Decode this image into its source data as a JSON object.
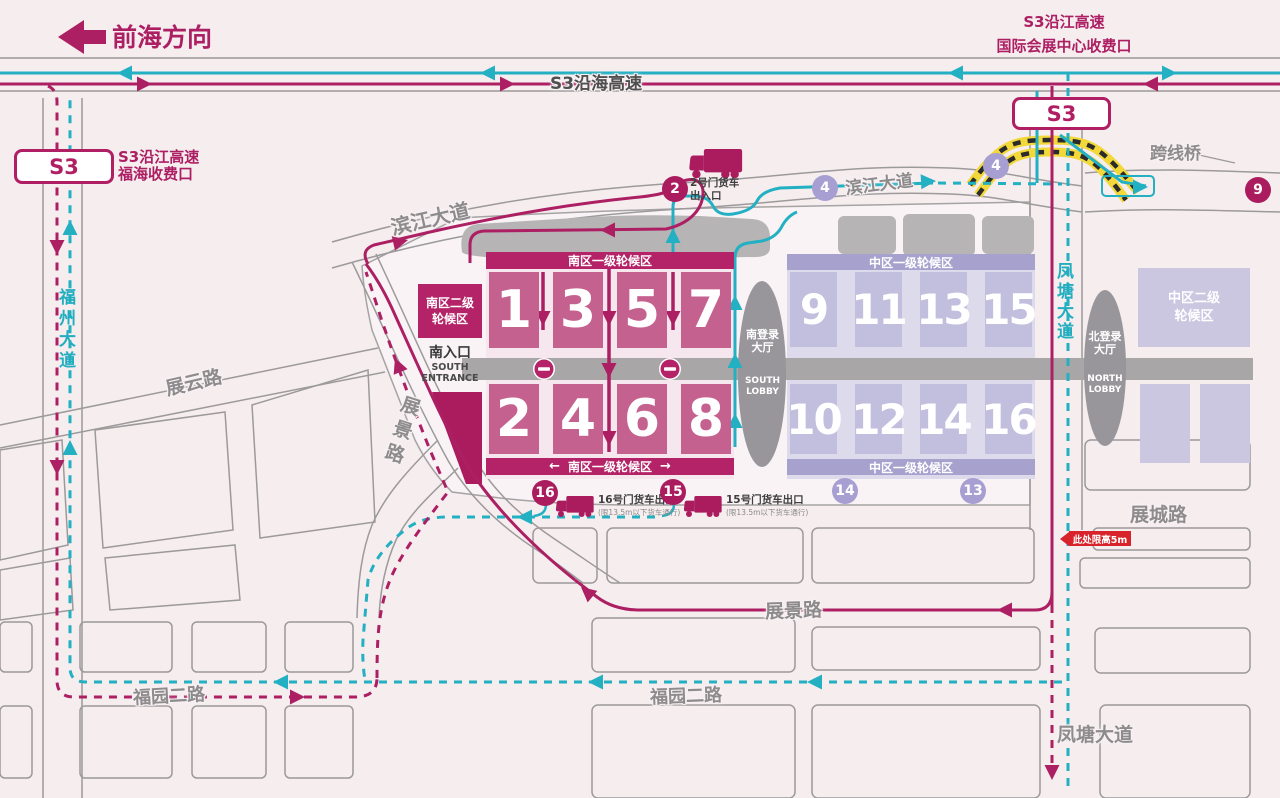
{
  "colors": {
    "background": "#f6edef",
    "magenta": "#ad1f63",
    "magenta_dark": "#b42367",
    "teal": "#22b0c2",
    "hall_south": "#c5618e",
    "zone_south": "#f5e7ed",
    "banner_south": "#b42367",
    "hall_central": "#c2bede",
    "zone_central": "#dddaec",
    "banner_central": "#a7a1ce",
    "waypoint_purple": "#a79fd2",
    "building_gray": "#b6b4b5",
    "road_gray": "#9b999a",
    "label_gray": "#8d8b8c",
    "alert_red": "#d8232a",
    "bridge_yellow": "#f3d83a"
  },
  "highway": {
    "qianhai_direction": "前海方向",
    "s3_coastal": "S3沿海高速",
    "s3_badge": "S3",
    "toll_right_line1": "S3沿江高速",
    "toll_right_line2": "国际会展中心收费口",
    "toll_left_line1": "S3沿江高速",
    "toll_left_line2": "福海收费口",
    "bridge": "跨线桥"
  },
  "roads": {
    "fuzhou_avenue": "福州大道",
    "binjiang_avenue": "滨江大道",
    "fengtang_avenue": "凤塘大道",
    "zhanyun_road": "展云路",
    "zhanjing_road": "展景路",
    "fuyuan_2nd_road": "福园二路",
    "zhancheng_road": "展城路"
  },
  "venue": {
    "south_zone_banner": "南区一级轮候区",
    "south_zone2_line1": "南区二级",
    "south_zone2_line2": "轮候区",
    "central_zone_banner": "中区一级轮候区",
    "central_zone2_line1": "中区二级",
    "central_zone2_line2": "轮候区",
    "south_entrance_cn": "南入口",
    "south_entrance_en1": "SOUTH",
    "south_entrance_en2": "ENTRANCE",
    "south_lobby_cn1": "南登录",
    "south_lobby_cn2": "大厅",
    "south_lobby_en1": "SOUTH",
    "south_lobby_en2": "LOBBY",
    "north_lobby_cn1": "北登录",
    "north_lobby_cn2": "大厅",
    "north_lobby_en1": "NORTH",
    "north_lobby_en2": "LOBBY",
    "halls_south": [
      "1",
      "3",
      "5",
      "7",
      "2",
      "4",
      "6",
      "8"
    ],
    "halls_central": [
      "9",
      "11",
      "13",
      "15",
      "10",
      "12",
      "14",
      "16"
    ]
  },
  "gates": {
    "gate2_no": "2",
    "gate2_line1": "2号门货车",
    "gate2_line2": "出入口",
    "gate16_no": "16",
    "gate16_label": "16号门货车出口",
    "gate16_sub": "(限13.5m以下货车通行)",
    "gate15_no": "15",
    "gate15_label": "15号门货车出口",
    "gate15_sub": "(限13.5m以下货车通行)",
    "waypoint4": "4",
    "waypoint9": "9",
    "waypoint14": "14",
    "waypoint13": "13"
  },
  "notices": {
    "height_limit": "此处限高5m"
  },
  "icons": {
    "arrow_left": "←",
    "arrow_right": "→"
  }
}
